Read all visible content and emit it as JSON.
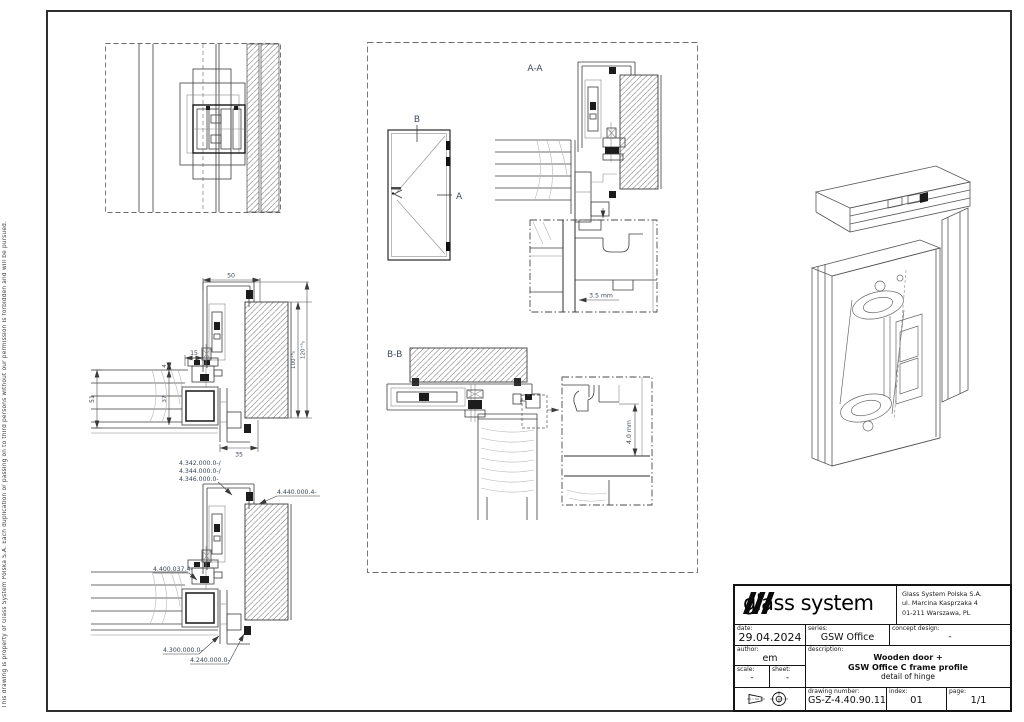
{
  "page": {
    "copyright": "This drawing is property of Glass System Polska S.A. Each duplication or passing on to third persons without our permission is forbidden and will be pursued."
  },
  "labels": {
    "section_aa": "A-A",
    "section_bb": "B-B",
    "marker_a": "A",
    "marker_b": "B",
    "gap_aa": "3.5 mm",
    "gap_bb": "4.0 mm"
  },
  "dimensions": {
    "d50": "50",
    "d15": "15",
    "d4": "4",
    "d51": "51",
    "d37": "37",
    "d35": "35",
    "d100": "100⁺⁵₀",
    "d120": "120⁺⁵₀"
  },
  "part_numbers": {
    "p1": "4.342.000.0-/",
    "p2": "4.344.000.0-/",
    "p3": "4.346.000.0-",
    "p4": "4.440.000.4-",
    "p5": "4.400.037.4-",
    "p6": "4.300.000.0-",
    "p7": "4.240.000.0-"
  },
  "title_block": {
    "logo_text": "glass system",
    "company_line1": "Glass System Polska S.A.",
    "company_line2": "ul. Marcina Kasprzaka 4",
    "company_line3": "01-211 Warszawa, PL",
    "date_label": "date:",
    "date_value": "29.04.2024",
    "series_label": "series:",
    "series_value": "GSW Office",
    "concept_label": "concept design:",
    "concept_value": "-",
    "author_label": "author:",
    "author_value": "em",
    "description_label": "description:",
    "description_line1": "Wooden door +",
    "description_line2": "GSW Office C frame profile",
    "description_line3": "detail of hinge",
    "scale_label": "scale:",
    "scale_value": "-",
    "sheet_label": "sheet:",
    "sheet_value": "-",
    "drawing_number_label": "drawing number:",
    "drawing_number_value": "GS-Z-4.40.90.11",
    "index_label": "index:",
    "index_value": "01",
    "page_label": "page:",
    "page_value": "1/1"
  }
}
